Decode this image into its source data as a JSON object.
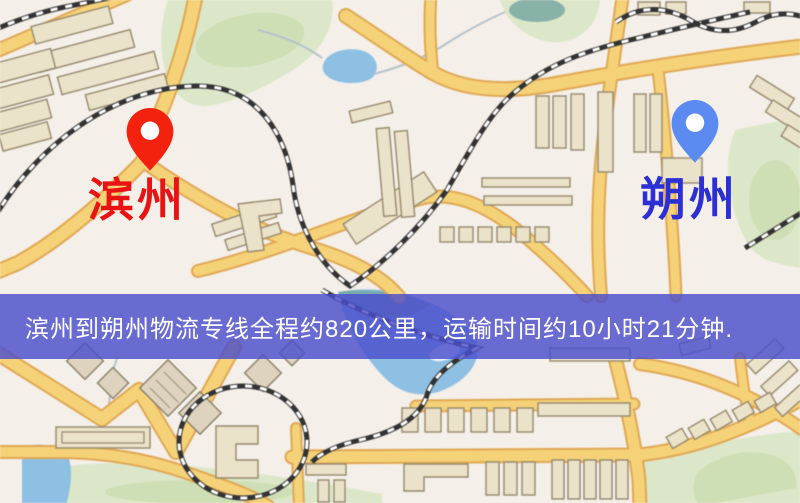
{
  "banner": {
    "text": "滨州到朔州物流专线全程约820公里，运输时间约10小时21分钟.",
    "background": "#4a4ecc",
    "background_opacity": 0.82,
    "text_color": "#ffffff"
  },
  "markers": {
    "origin": {
      "label": "滨州",
      "pin_color": "#f3220f",
      "label_color": "#e81414"
    },
    "destination": {
      "label": "朔州",
      "pin_color": "#5b8bf0",
      "label_color": "#2b2fd4"
    }
  },
  "map_palette": {
    "map_background": "#f4efe8",
    "road_fill": "#f6d273",
    "road_casing": "#e2a750",
    "building_fill": "#ebe2c9",
    "building_stroke": "#95896c",
    "park": "#dce7c8",
    "park_dark": "#cdddb0",
    "water": "#8cc0e6",
    "railway_dark": "#333333",
    "railway_light": "#ffffff"
  }
}
